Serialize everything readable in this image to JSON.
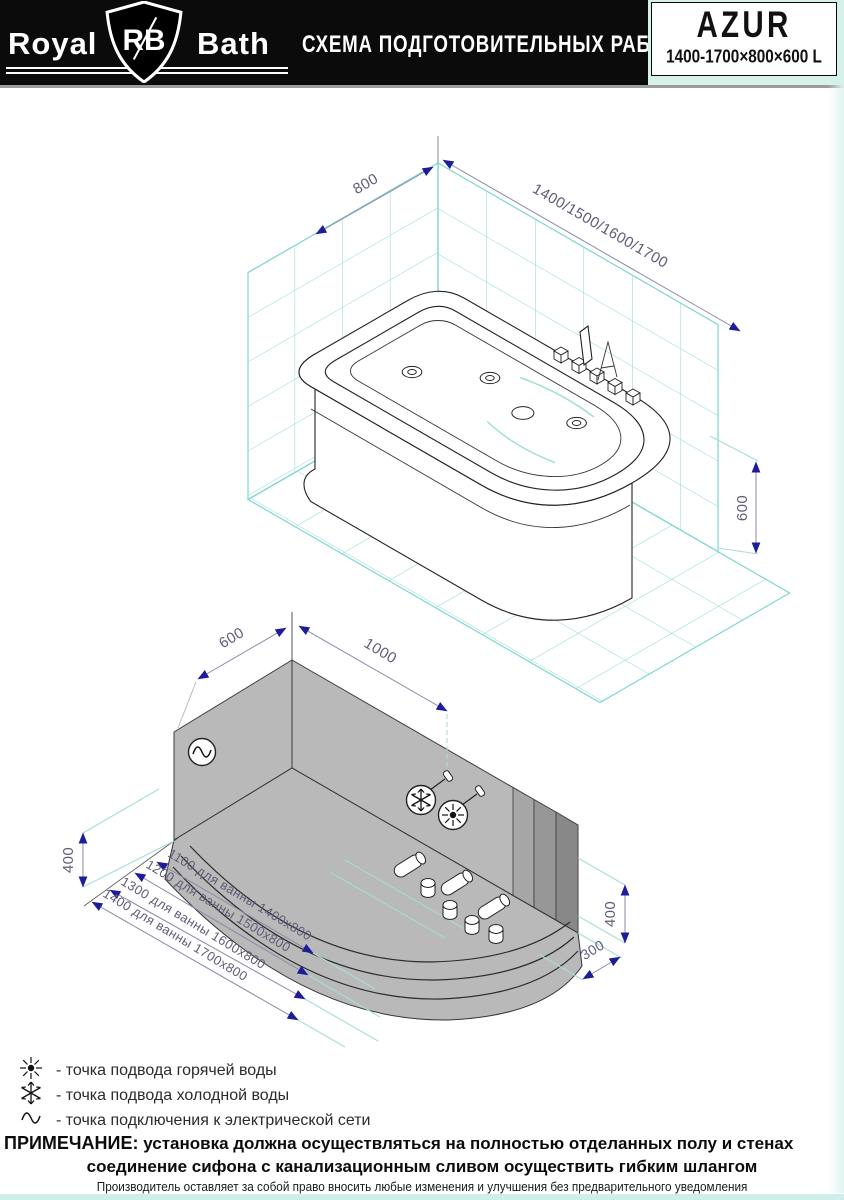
{
  "header": {
    "brand_left": "Royal",
    "brand_shield": "RB",
    "brand_right": "Bath",
    "doc_title": "СХЕМА ПОДГОТОВИТЕЛЬНЫХ РАБОТ",
    "model": "AZUR",
    "model_size": "1400-1700×800×600 L"
  },
  "upper_drawing": {
    "dim_depth": "800",
    "dim_lengths": "1400/1500/1600/1700",
    "dim_height": "600"
  },
  "lower_drawing": {
    "dim_wall_left": "600",
    "dim_wall_top": "1000",
    "dim_height_left": "400",
    "dim_height_right": "400",
    "dim_offset_right": "300",
    "diagonal_dims": [
      {
        "label": "1100 для ванны 1400x800"
      },
      {
        "label": "1200 для ванны 1500x800"
      },
      {
        "label": "1300 для ванны 1600x800"
      },
      {
        "label": "1400 для ванны 1700x800"
      }
    ]
  },
  "legend": {
    "items": [
      {
        "icon": "hot-water-icon",
        "label": "- точка подвода горячей воды"
      },
      {
        "icon": "cold-water-icon",
        "label": "- точка подвода холодной воды"
      },
      {
        "icon": "electric-icon",
        "label": "- точка подключения к электрической сети"
      }
    ]
  },
  "note": {
    "label": "ПРИМЕЧАНИЕ:",
    "line1": "установка должна осуществляться на полностью отделанных полу и стенах",
    "line2": "соединение сифона с канализационным сливом осуществить гибким шлангом"
  },
  "footer": "Производитель оставляет за собой право вносить любые изменения и улучшения без предварительного уведомления",
  "colors": {
    "header_bg": "#0b0b0b",
    "tile_cyan": "#7fd6d2",
    "dim_arrow_navy": "#1d1d9a",
    "dim_text": "#5d5d78",
    "wall_gray": "#b9b9b9",
    "mint": "#d6f0ea"
  }
}
